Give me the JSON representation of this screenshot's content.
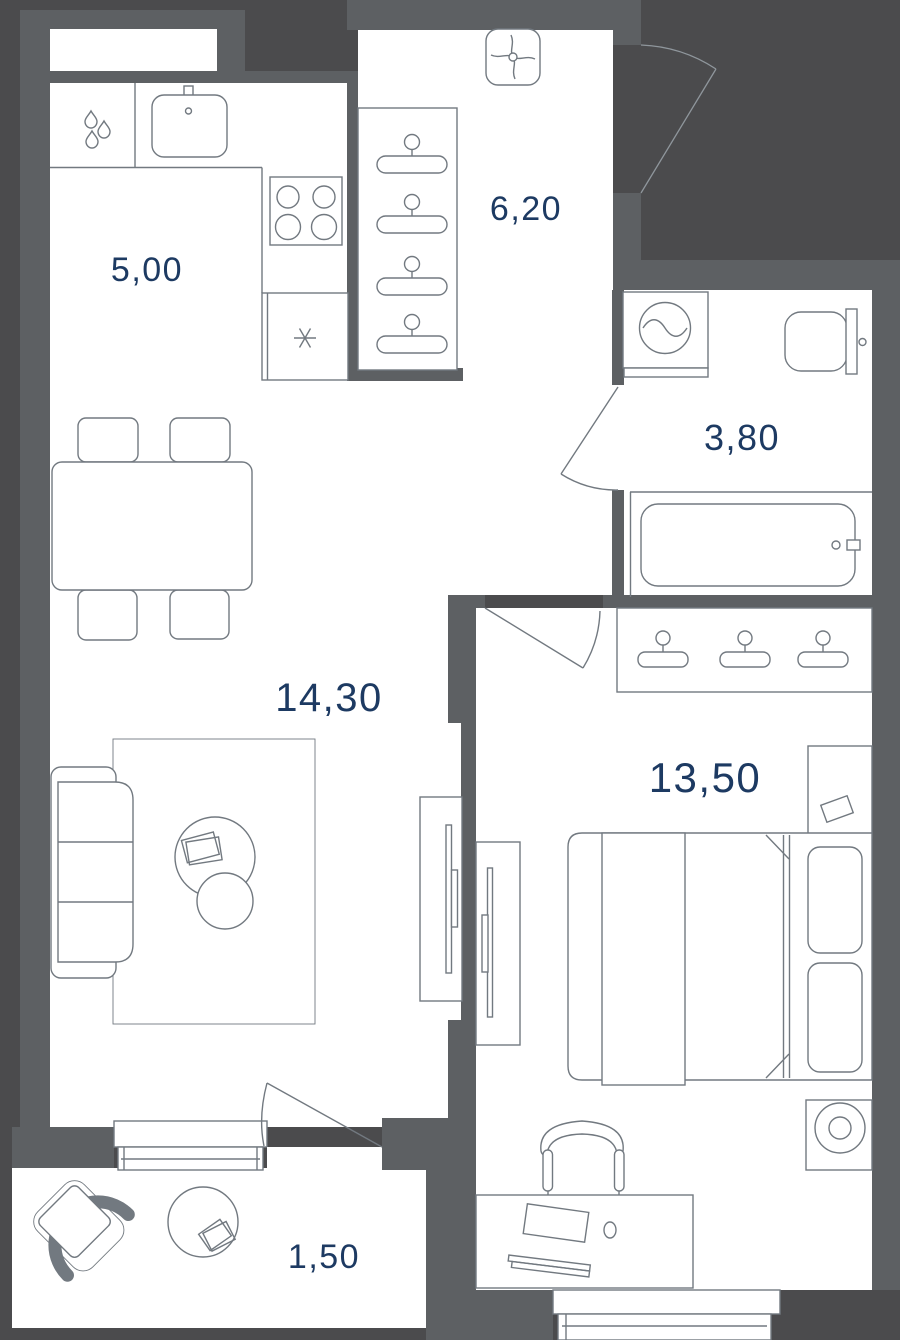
{
  "rooms": [
    {
      "key": "kitchen",
      "label": "5,00"
    },
    {
      "key": "hallway",
      "label": "6,20"
    },
    {
      "key": "bathroom",
      "label": "3,80"
    },
    {
      "key": "living-room",
      "label": "14,30"
    },
    {
      "key": "bedroom",
      "label": "13,50"
    },
    {
      "key": "balcony",
      "label": "1,50"
    }
  ],
  "colors": {
    "background": "#4b4b4d",
    "wall": "#5d6063",
    "floor": "#ffffff",
    "furniture_outline": "#727980",
    "door_outline": "#8f969c",
    "label_text": "#1d3a62"
  }
}
